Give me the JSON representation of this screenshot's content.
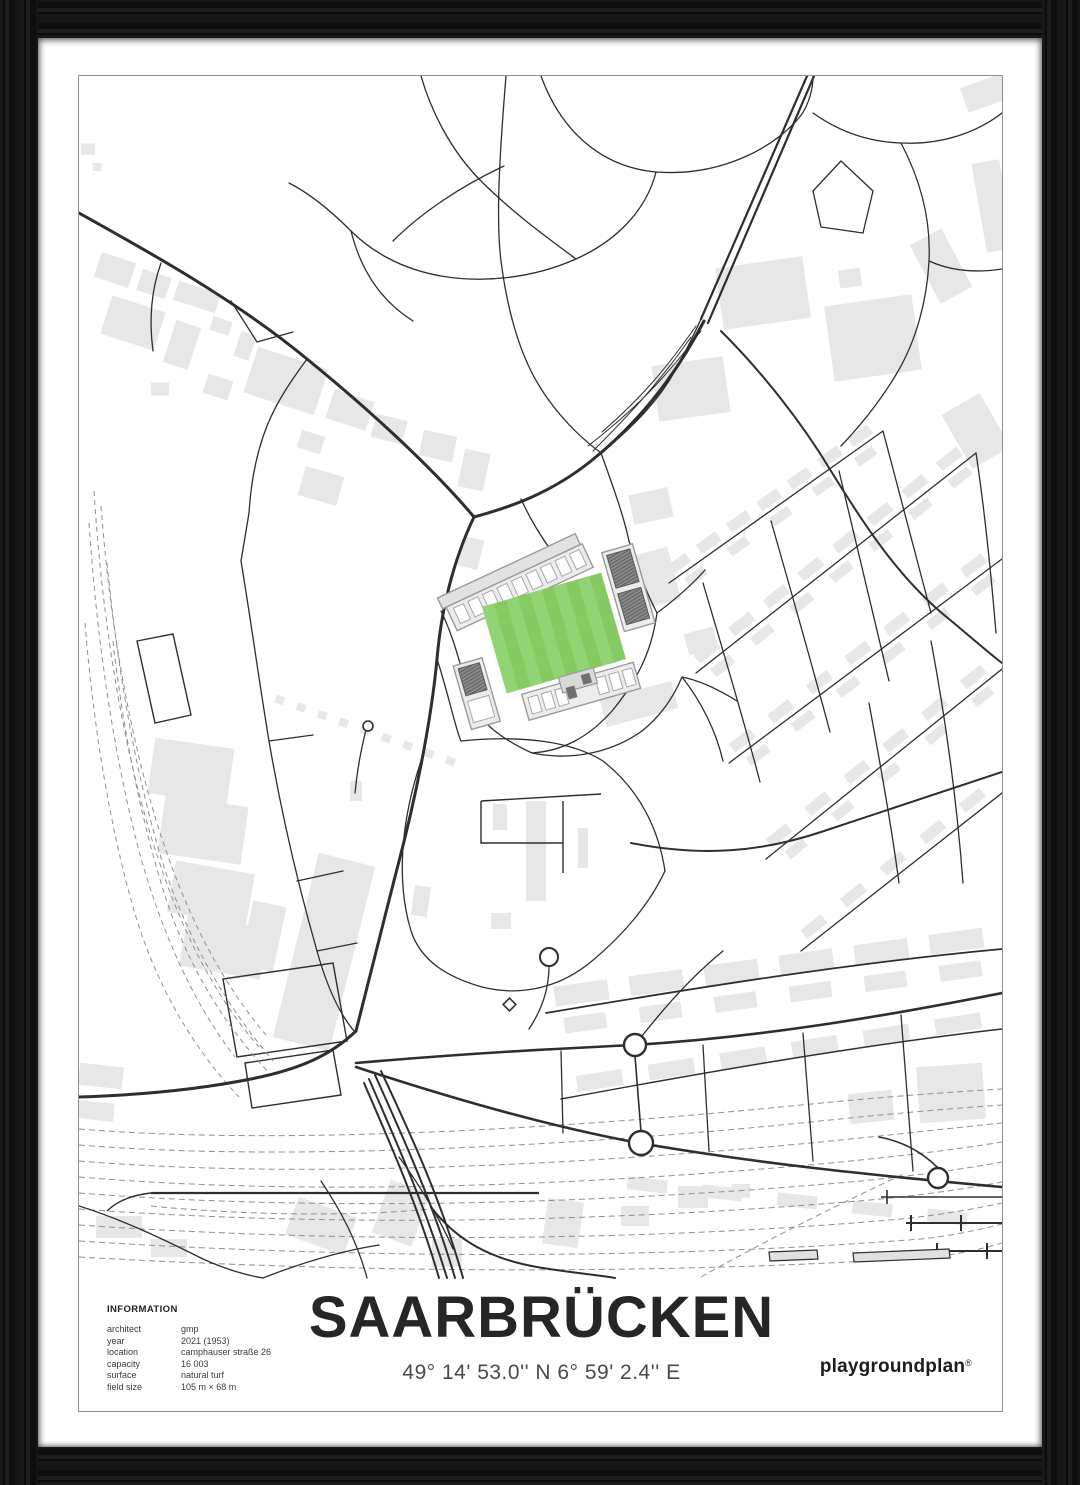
{
  "poster": {
    "title": "SAARBRÜCKEN",
    "coordinates": "49° 14' 53.0'' N  6° 59' 2.4'' E"
  },
  "info": {
    "heading": "INFORMATION",
    "rows": [
      {
        "label": "architect",
        "value": "gmp"
      },
      {
        "label": "year",
        "value": "2021 (1953)"
      },
      {
        "label": "location",
        "value": "camphauser straße 26"
      },
      {
        "label": "capacity",
        "value": "16 003"
      },
      {
        "label": "surface",
        "value": "natural turf"
      },
      {
        "label": "field size",
        "value": "105 m × 68 m"
      }
    ]
  },
  "brand": {
    "name": "playgroundplan",
    "registered_mark": "®"
  },
  "colors": {
    "frame": "#141414",
    "mat": "#ffffff",
    "print_border": "#8f8f8f",
    "road_line": "#2e2e2e",
    "building_fill": "#e7e7e7",
    "railway_dash": "#8f8f8f",
    "pitch_green": "#85ca63",
    "pitch_stripe_green": "#92d373",
    "stand_fill": "#ececec",
    "stand_dark": "#8a8a8a"
  }
}
